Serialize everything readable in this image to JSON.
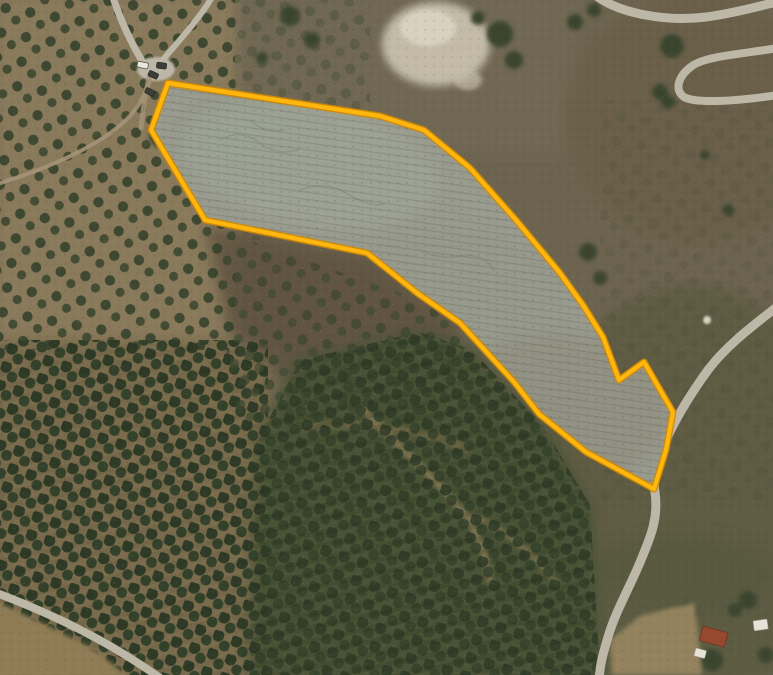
{
  "canvas": {
    "width": 773,
    "height": 675,
    "view": "satellite-aerial"
  },
  "colors": {
    "parcel_outline": "#FFB60F",
    "parcel_outline_edge": "#D18A00",
    "parcel_fill": "#989B8E",
    "olive_grove_ground": "#8A7A5B",
    "olive_grove_ground_dark": "#7A6C4E",
    "olive_tree": "#3A452D",
    "dense_scrub": "#495234",
    "scrub_right": "#675E46",
    "road": "#BDB7A7",
    "dirt_track": "#A59478",
    "rocky_outcrop": "#CCC5B2",
    "bare_field": "#96855F",
    "farmhouse_roof": "#96492F"
  },
  "parcel": {
    "points": "168,83 380,116 424,130 470,168 516,220 560,273 583,305 603,337 619,380 644,362 673,412 666,450 654,489 586,452 539,414 514,382 460,323 417,293 367,253 205,220 151,130",
    "vertex_count": 21
  },
  "roads": {
    "access_left_branch": {
      "d": "M 112,-6 C 120,20 132,46 150,74"
    },
    "access_right_branch": {
      "d": "M 214,-6 C 198,22 170,50 152,73"
    },
    "junction_stub": {
      "d": "M 149,78 C 145,95 143,110 141,128"
    },
    "dirt_track_southwest": {
      "d": "M 150,80 C 141,108 127,122 103,138 C 75,156 37,172 -6,185"
    },
    "serpentine_upper": {
      "d": "M 594,-6 C 618,14 668,22 706,17 C 736,13 758,6 778,2"
    },
    "serpentine_lower": {
      "d": "M 778,48 C 742,54 706,56 692,66 C 678,76 674,90 684,97 C 696,104 738,101 778,95"
    },
    "main_road": {
      "d": "M 778,306 C 750,328 726,346 708,370 C 692,392 676,418 665,442 C 657,460 652,476 655,492 C 659,520 649,540 641,560 C 631,585 616,610 608,637 C 603,654 600,664 599,680"
    },
    "bottom_left_track": {
      "d": "M -6,592 C 55,615 110,642 163,680"
    }
  },
  "vehicles": [
    {
      "shade": "light",
      "transform": "translate(138,61) rotate(12)"
    },
    {
      "shade": "dark",
      "transform": "translate(157,62) rotate(8)"
    },
    {
      "shade": "dark",
      "transform": "translate(150,70) rotate(25)"
    },
    {
      "shade": "dark",
      "transform": "translate(147,87) rotate(28)"
    }
  ],
  "structures": {
    "farmhouse_roof": {
      "transform": "translate(703,626) rotate(15)"
    },
    "outbuilding_white": {
      "transform": "translate(696,648) rotate(15)"
    },
    "building_white_right": {
      "transform": "translate(753,621) rotate(-8)"
    }
  }
}
